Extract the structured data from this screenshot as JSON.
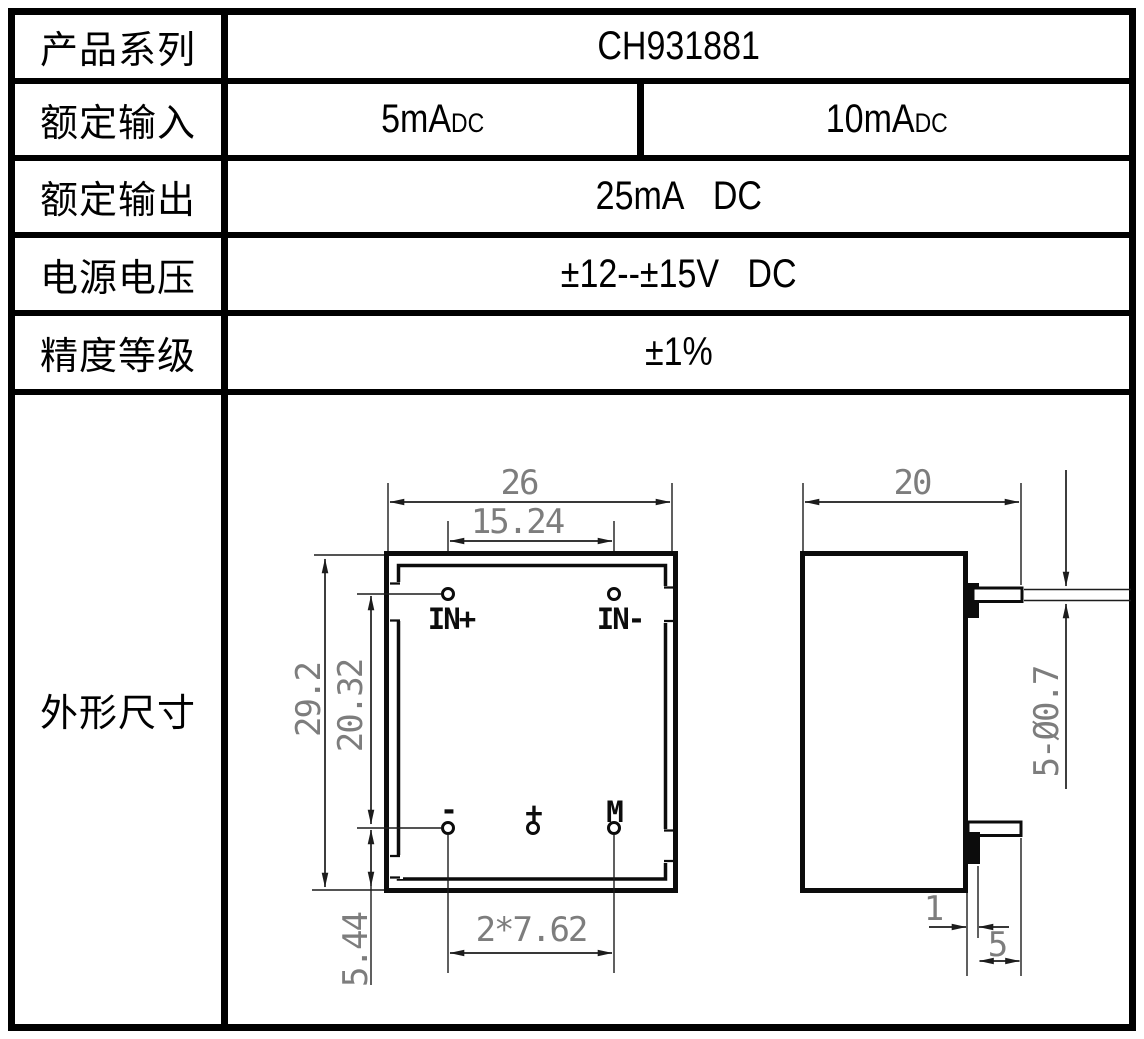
{
  "table": {
    "rows": [
      {
        "label": "产品系列",
        "value": "CH931881"
      },
      {
        "label": "额定输入",
        "value_left_main": "5mA",
        "value_left_sub": "DC",
        "value_right_main": "10mA",
        "value_right_sub": "DC"
      },
      {
        "label": "额定输出",
        "value": "25mA   DC"
      },
      {
        "label": "电源电压",
        "value": "±12--±15V   DC"
      },
      {
        "label": "精度等级",
        "value": "±1%"
      },
      {
        "label": "外形尺寸"
      }
    ]
  },
  "drawing": {
    "front": {
      "width": "26",
      "top_pin_pitch": "15.24",
      "body_height": "29.2",
      "pin_row_gap": "20.32",
      "bottom_pin_offset": "5.44",
      "bottom_pin_pitch": "2*7.62",
      "pin_in_plus": "IN+",
      "pin_in_minus": "IN-",
      "pin_neg": "-",
      "pin_pos": "+",
      "pin_m": "M"
    },
    "side": {
      "depth": "20",
      "pin_spec": "5-Ø0.7",
      "pin_offset": "1",
      "pin_length": "5"
    },
    "colors": {
      "line": "#1c1c1c",
      "dim_text": "#7d7d7d",
      "body": "#0c0c0c"
    }
  }
}
